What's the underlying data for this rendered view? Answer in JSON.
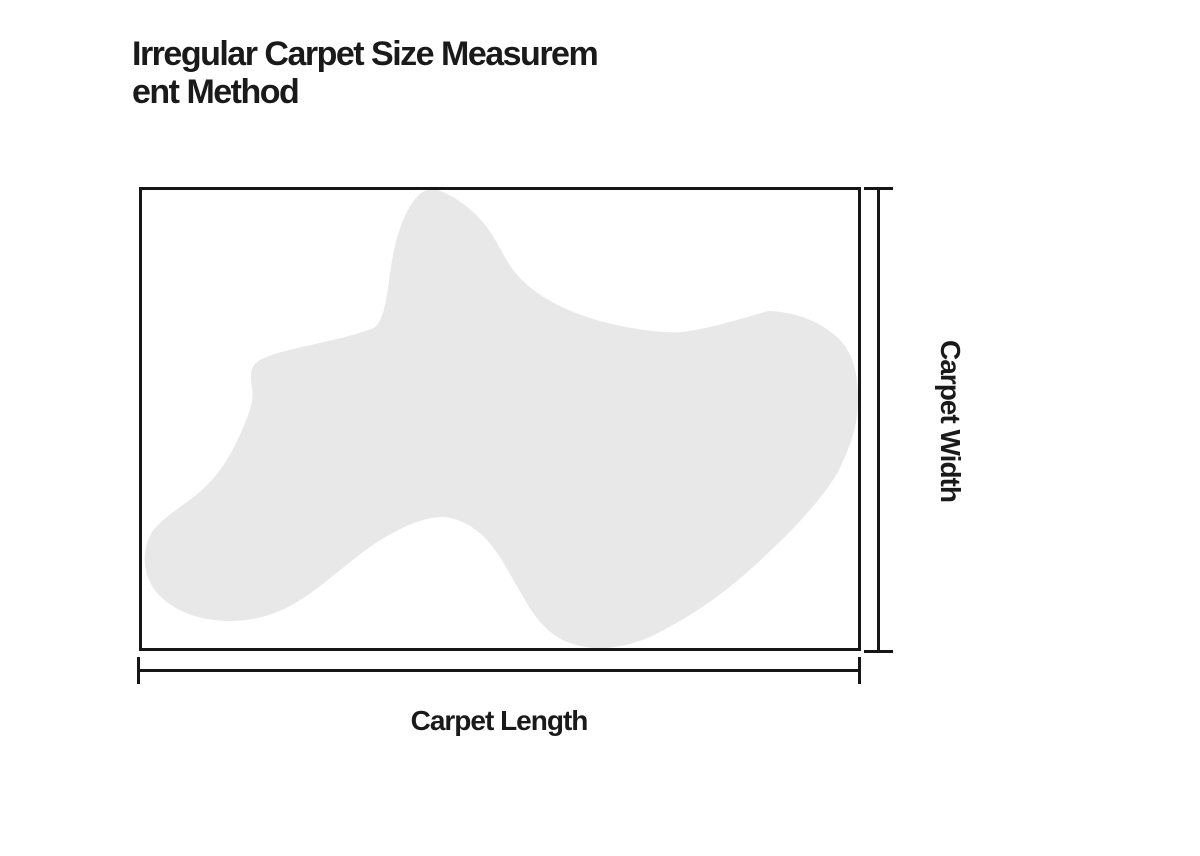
{
  "title": {
    "line1": "Irregular Carpet Size Measurem",
    "line2": "ent Method"
  },
  "labels": {
    "width": "Carpet Width",
    "length": "Carpet Length"
  },
  "colors": {
    "text": "#1a1a1a",
    "line": "#161616",
    "carpet_fill": "#e9e8e8",
    "background": "#ffffff"
  }
}
